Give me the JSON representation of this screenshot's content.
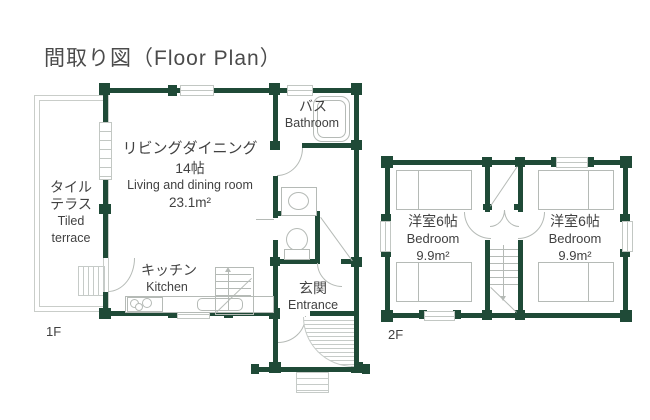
{
  "title": "間取り図（Floor Plan）",
  "colors": {
    "wall": "#1f4a37",
    "fixture": "#b5bab6",
    "text": "#414141"
  },
  "floor1": {
    "label": "1F",
    "terrace": {
      "name_jp_line1": "タイル",
      "name_jp_line2": "テラス",
      "name_en_line1": "Tiled",
      "name_en_line2": "terrace"
    },
    "living": {
      "name_jp": "リビングダイニング",
      "size_jp": "14帖",
      "name_en": "Living and dining room",
      "area": "23.1m²"
    },
    "bath": {
      "name_jp": "バス",
      "name_en": "Bathroom"
    },
    "kitchen": {
      "name_jp": "キッチン",
      "name_en": "Kitchen"
    },
    "entrance": {
      "name_jp": "玄関",
      "name_en": "Entrance"
    }
  },
  "floor2": {
    "label": "2F",
    "bedroom_left": {
      "name_jp": "洋室6帖",
      "name_en": "Bedroom",
      "area": "9.9m²"
    },
    "bedroom_right": {
      "name_jp": "洋室6帖",
      "name_en": "Bedroom",
      "area": "9.9m²"
    }
  }
}
